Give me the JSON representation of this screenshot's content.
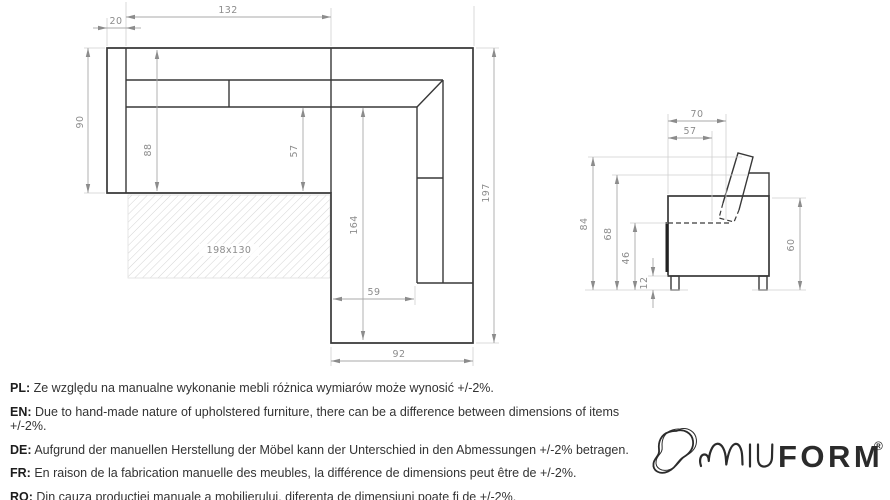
{
  "drawing": {
    "top_view": {
      "mattress_label": "198x130",
      "dims": {
        "armrest_width": "20",
        "seat_width": "132",
        "total_depth": "90",
        "inner_depth": "88",
        "seat_depth": "57",
        "chaise_length": "164",
        "total_length": "197",
        "chaise_seat_width": "59",
        "chaise_width": "92"
      }
    },
    "side_view": {
      "dims": {
        "total_depth": "70",
        "seat_depth": "57",
        "total_height": "84",
        "backrest_height": "68",
        "seat_height": "46",
        "leg_height": "12",
        "body_height": "60"
      }
    }
  },
  "disclaimers": [
    {
      "label": "PL:",
      "text": "Ze względu na manualne wykonanie mebli różnica wymiarów może wynosić +/-2%."
    },
    {
      "label": "EN:",
      "text": "Due to hand-made nature of upholstered furniture, there can be a difference between dimensions of items +/-2%."
    },
    {
      "label": "DE:",
      "text": "Aufgrund der manuellen Herstellung der Möbel kann der Unterschied in den Abmessungen +/-2% betragen."
    },
    {
      "label": "FR:",
      "text": "En raison de la fabrication manuelle des meubles, la différence de dimensions peut être de +/-2%."
    },
    {
      "label": "RO:",
      "text": "Din cauza producției manuale a mobilierului, diferența de dimensiuni poate fi de +/-2%."
    }
  ],
  "brand": {
    "bold": "FORM",
    "registered": "®"
  },
  "colors": {
    "line_dark": "#383838",
    "line_dim": "#a8a8a8",
    "text": "#333333",
    "logo": "#2b2b2b"
  }
}
